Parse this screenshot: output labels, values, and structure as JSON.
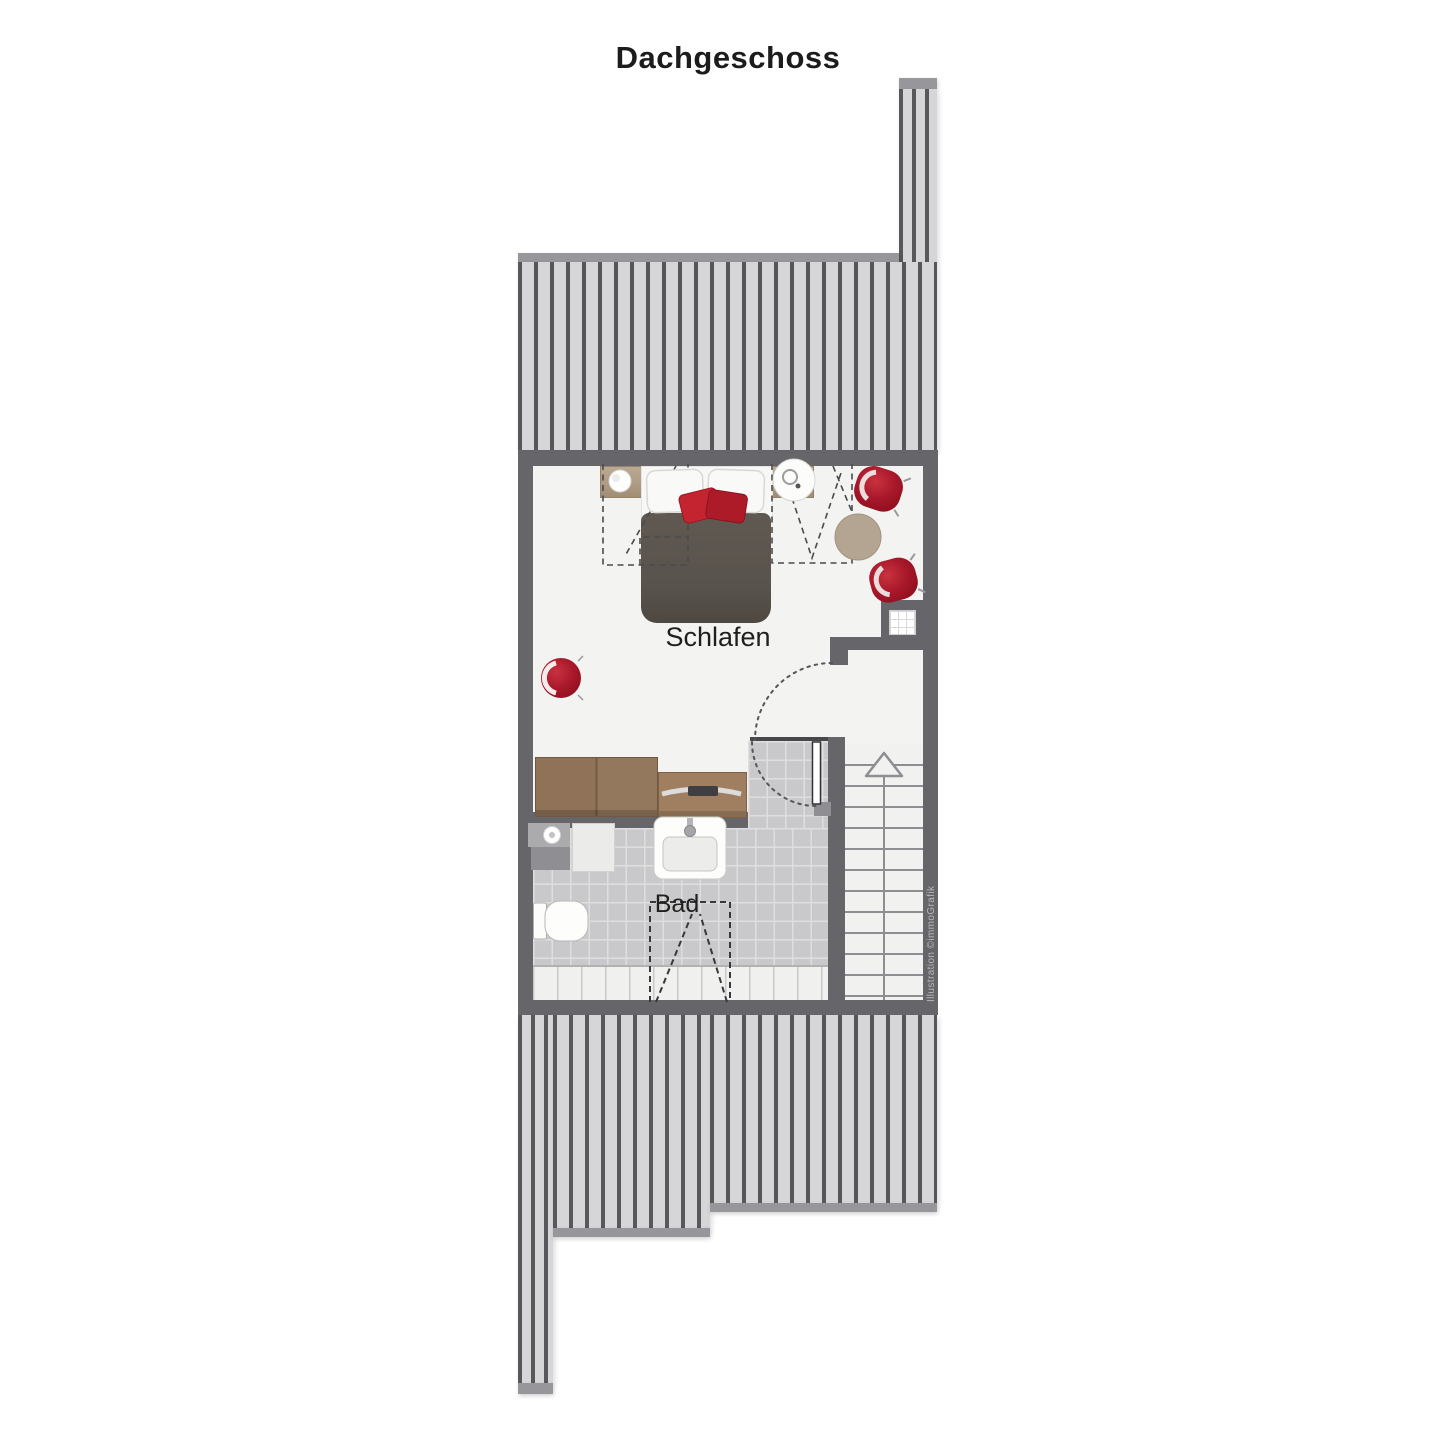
{
  "title": "Dachgeschoss",
  "rooms": {
    "bedroom": "Schlafen",
    "bathroom": "Bad"
  },
  "credit": "Illustration ©immoGrafik",
  "colors": {
    "wall": "#66666a",
    "roof_hatch_bg": "#d6d6d8",
    "roof_hatch_line": "#58585c",
    "roof_cap": "#97979b",
    "floor": "#f3f3f1",
    "bath_tile": "#c9c9cb",
    "accent_red": "#a8182a",
    "bed_blanket": "#59534d",
    "wood": "#8f7258"
  },
  "furniture_icons": [
    "double-bed",
    "pillow",
    "red-cushion",
    "nightstand",
    "bedside-lamp",
    "round-side-table",
    "red-armchair",
    "red-armchair",
    "red-pouf",
    "round-rug",
    "wardrobe",
    "dresser",
    "washbasin-counter",
    "washing-machine",
    "sink",
    "toilet",
    "staircase-up-arrow",
    "shaft",
    "door-swing"
  ]
}
